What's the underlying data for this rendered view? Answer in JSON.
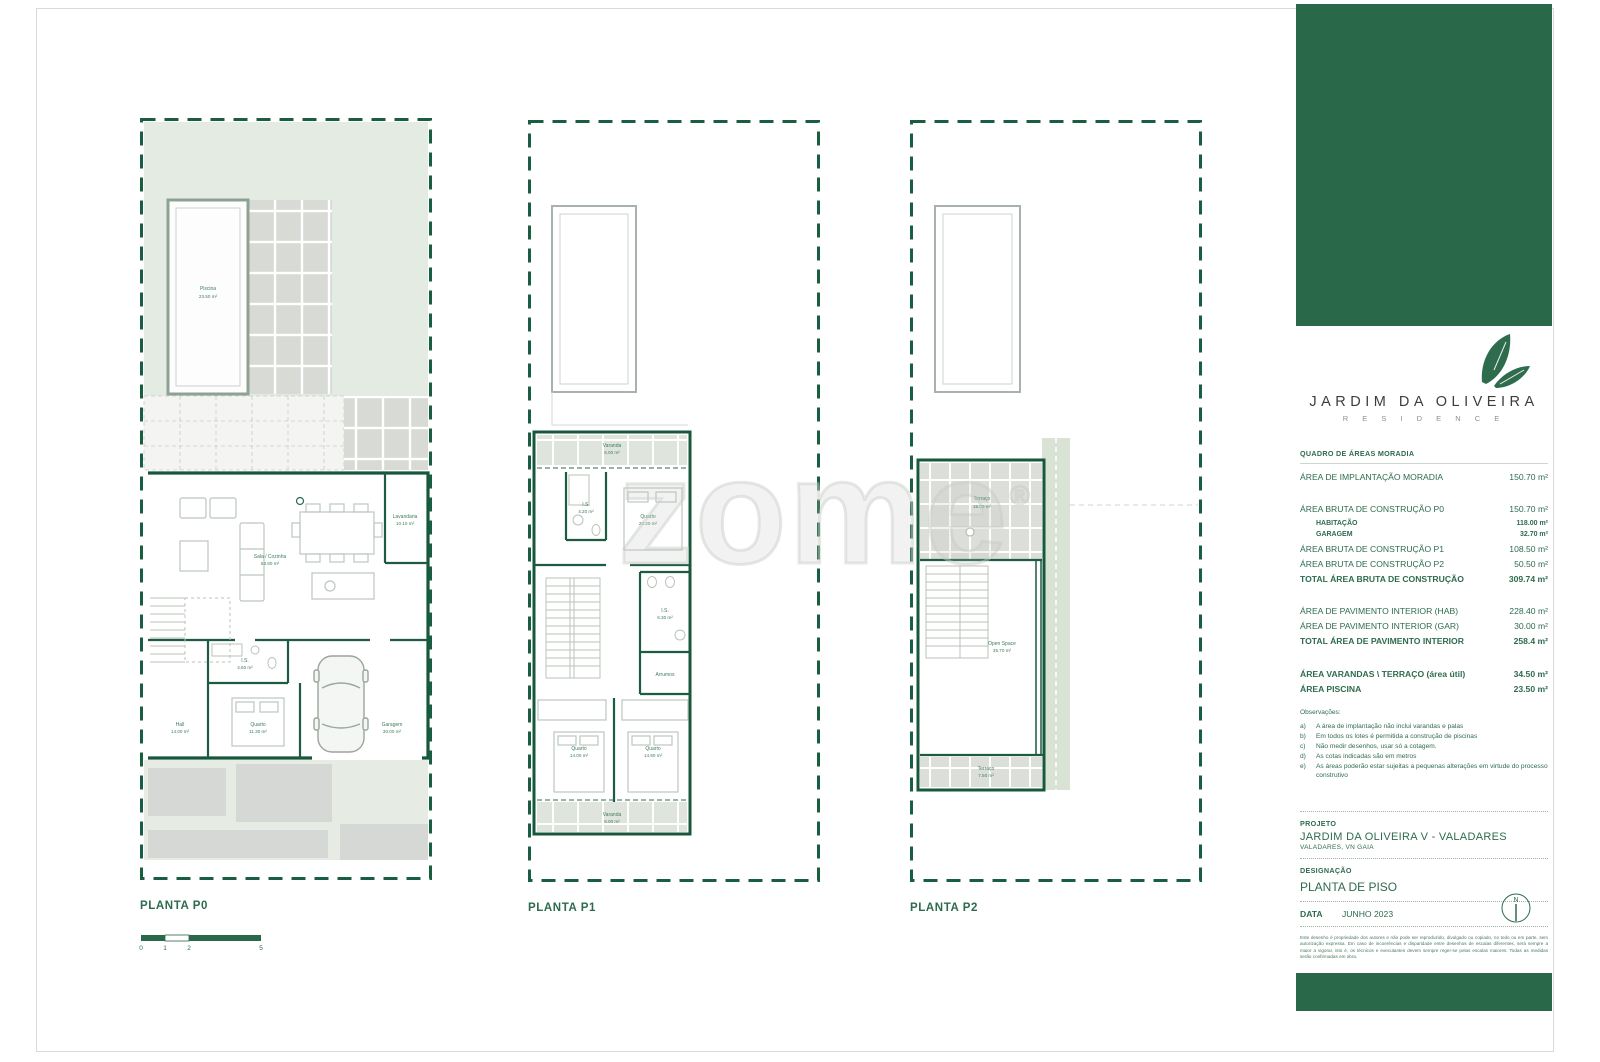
{
  "sidebar": {
    "logo": {
      "title": "JARDIM DA OLIVEIRA",
      "subtitle": "R E S I D E N C E"
    },
    "areas": {
      "header": "QUADRO DE ÁREAS MORADIA",
      "rows": [
        {
          "label": "ÁREA DE IMPLANTAÇÃO MORADIA",
          "value": "150.70 m²"
        },
        {
          "label": "ÁREA BRUTA DE CONSTRUÇÃO P0",
          "value": "150.70 m²"
        },
        {
          "label": "HABITAÇÃO",
          "value": "118.00 m²"
        },
        {
          "label": "GARAGEM",
          "value": "32.70 m²"
        },
        {
          "label": "ÁREA BRUTA DE CONSTRUÇÃO P1",
          "value": "108.50 m²"
        },
        {
          "label": "ÁREA BRUTA DE CONSTRUÇÃO P2",
          "value": "50.50 m²"
        },
        {
          "label": "TOTAL ÁREA BRUTA DE CONSTRUÇÃO",
          "value": "309.74 m²"
        },
        {
          "label": "ÁREA DE PAVIMENTO INTERIOR (HAB)",
          "value": "228.40 m²"
        },
        {
          "label": "ÁREA DE PAVIMENTO INTERIOR (GAR)",
          "value": "30.00 m²"
        },
        {
          "label": "TOTAL ÁREA DE PAVIMENTO INTERIOR",
          "value": "258.4 m²"
        },
        {
          "label": "ÁREA VARANDAS \\ TERRAÇO (área útil)",
          "value": "34.50 m²"
        },
        {
          "label": "ÁREA PISCINA",
          "value": "23.50 m²"
        }
      ]
    },
    "observations": {
      "title": "Observações:",
      "items": [
        {
          "key": "a)",
          "text": "A área de implantação não inclui varandas e palas"
        },
        {
          "key": "b)",
          "text": "Em todos os lotes é permitida a construção de piscinas"
        },
        {
          "key": "c)",
          "text": "Não medir desenhos, usar só a cotagem."
        },
        {
          "key": "d)",
          "text": "As cotas indicadas são em metros"
        },
        {
          "key": "e)",
          "text": "As áreas poderão estar sujeitas a pequenas alterações em virtude do processo construtivo"
        }
      ]
    },
    "project": {
      "label": "PROJETO",
      "name": "JARDIM DA OLIVEIRA V - VALADARES",
      "location": "VALADARES, VN GAIA"
    },
    "designation": {
      "label": "DESIGNAÇÃO",
      "value": "PLANTA DE PISO"
    },
    "date": {
      "label": "DATA",
      "value": "JUNHO 2023"
    },
    "north_letter": "N",
    "disclaimer": "Este desenho é propriedade dos autores e não pode ser reproduzido, divulgado ou copiado, no todo ou em parte, sem autorização expressa. Em caso de incoerências e disparidade entre desenhos de escalas diferentes, será sempre a maior a vigorar, isto é, os técnicos e executantes devem sempre reger-se pelas escalas maiores. Todas as medidas serão confirmadas em obra."
  },
  "plans": {
    "p0": {
      "title": "PLANTA P0",
      "rooms": {
        "piscina": {
          "name": "Piscina",
          "area": "23.50 m²"
        },
        "sala": {
          "name": "Sala / Cozinha",
          "area": "63.90 m²"
        },
        "lavandaria": {
          "name": "Lavandaria",
          "area": "10.10 m²"
        },
        "is": {
          "name": "I.S.",
          "area": "4.60 m²"
        },
        "hall": {
          "name": "Hall",
          "area": "14.00 m²"
        },
        "quarto": {
          "name": "Quarto",
          "area": "11.30 m²"
        },
        "garagem": {
          "name": "Garagem",
          "area": "30.00 m²"
        }
      }
    },
    "p1": {
      "title": "PLANTA P1",
      "rooms": {
        "varanda_top": {
          "name": "Varanda",
          "area": "6.00 m²"
        },
        "is1": {
          "name": "I.S.",
          "area": "4.20 m²"
        },
        "quarto1": {
          "name": "Quarto",
          "area": "20.20 m²"
        },
        "is2": {
          "name": "I.S.",
          "area": "6.30 m²"
        },
        "arrumos": {
          "name": "Arrumos",
          "area": ""
        },
        "quarto2": {
          "name": "Quarto",
          "area": "14.00 m²"
        },
        "quarto3": {
          "name": "Quarto",
          "area": "14.90 m²"
        },
        "varanda_bottom": {
          "name": "Varanda",
          "area": "6.00 m²"
        }
      }
    },
    "p2": {
      "title": "PLANTA P2",
      "rooms": {
        "terraco_top": {
          "name": "Terraço",
          "area": "15.00 m²"
        },
        "open_space": {
          "name": "Open Space",
          "area": "35.70 m²"
        },
        "terraco_bottom": {
          "name": "Terraço",
          "area": "7.50 m²"
        }
      }
    }
  },
  "scalebar": {
    "ticks": [
      "0",
      "1",
      "2",
      "5"
    ]
  },
  "watermark": {
    "text": "zome",
    "reg": "®"
  },
  "colors": {
    "brand_green": "#2a684a",
    "line_green": "#17573c",
    "text_green": "#2e6b4e",
    "garden": "#e3ebe2"
  }
}
